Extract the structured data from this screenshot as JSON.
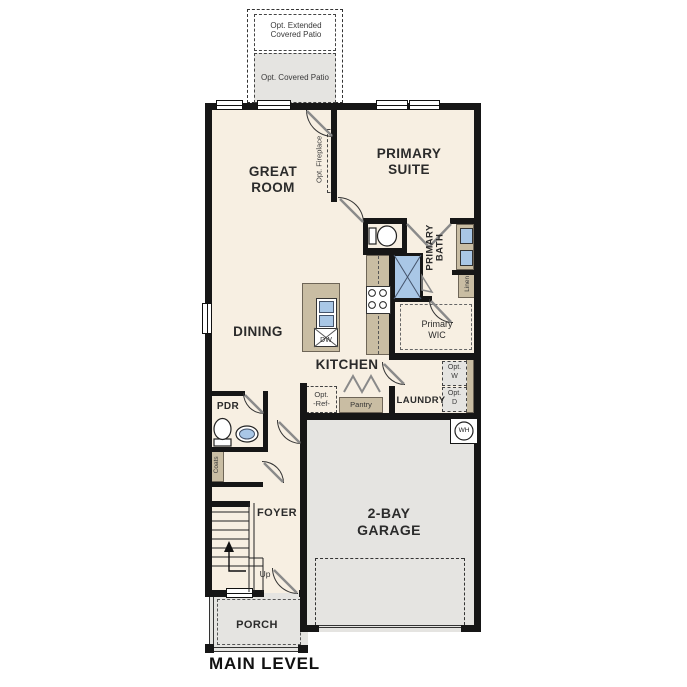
{
  "plan_title": "MAIN LEVEL",
  "labels": {
    "opt_extended_patio": "Opt. Extended Covered Patio",
    "opt_covered_patio": "Opt. Covered Patio",
    "great_room": "GREAT ROOM",
    "opt_fireplace": "Opt. Fireplace",
    "primary_suite": "PRIMARY SUITE",
    "primary_bath": "PRIMARY BATH",
    "linen": "Linen",
    "primary_wic": "Primary WIC",
    "dining": "DINING",
    "kitchen": "KITCHEN",
    "dishwasher": "DW",
    "pdr": "PDR",
    "coats": "Coats",
    "opt_ref_1": "Opt.",
    "opt_ref_2": "-Ref-",
    "pantry": "Pantry",
    "laundry": "LAUNDRY",
    "opt_w_1": "Opt.",
    "opt_w_2": "W",
    "opt_d_1": "Opt.",
    "opt_d_2": "D",
    "water_heater": "WH",
    "garage": "2-BAY GARAGE",
    "foyer": "FOYER",
    "up": "Up",
    "porch": "PORCH"
  },
  "colors": {
    "floor_cream": "#f7efe2",
    "outdoor_gray": "#e5e4e1",
    "cabinet_tan": "#c9bda3",
    "fixture_blue": "#a9c7e6",
    "wall_black": "#161616",
    "text": "#2b2b2b"
  }
}
